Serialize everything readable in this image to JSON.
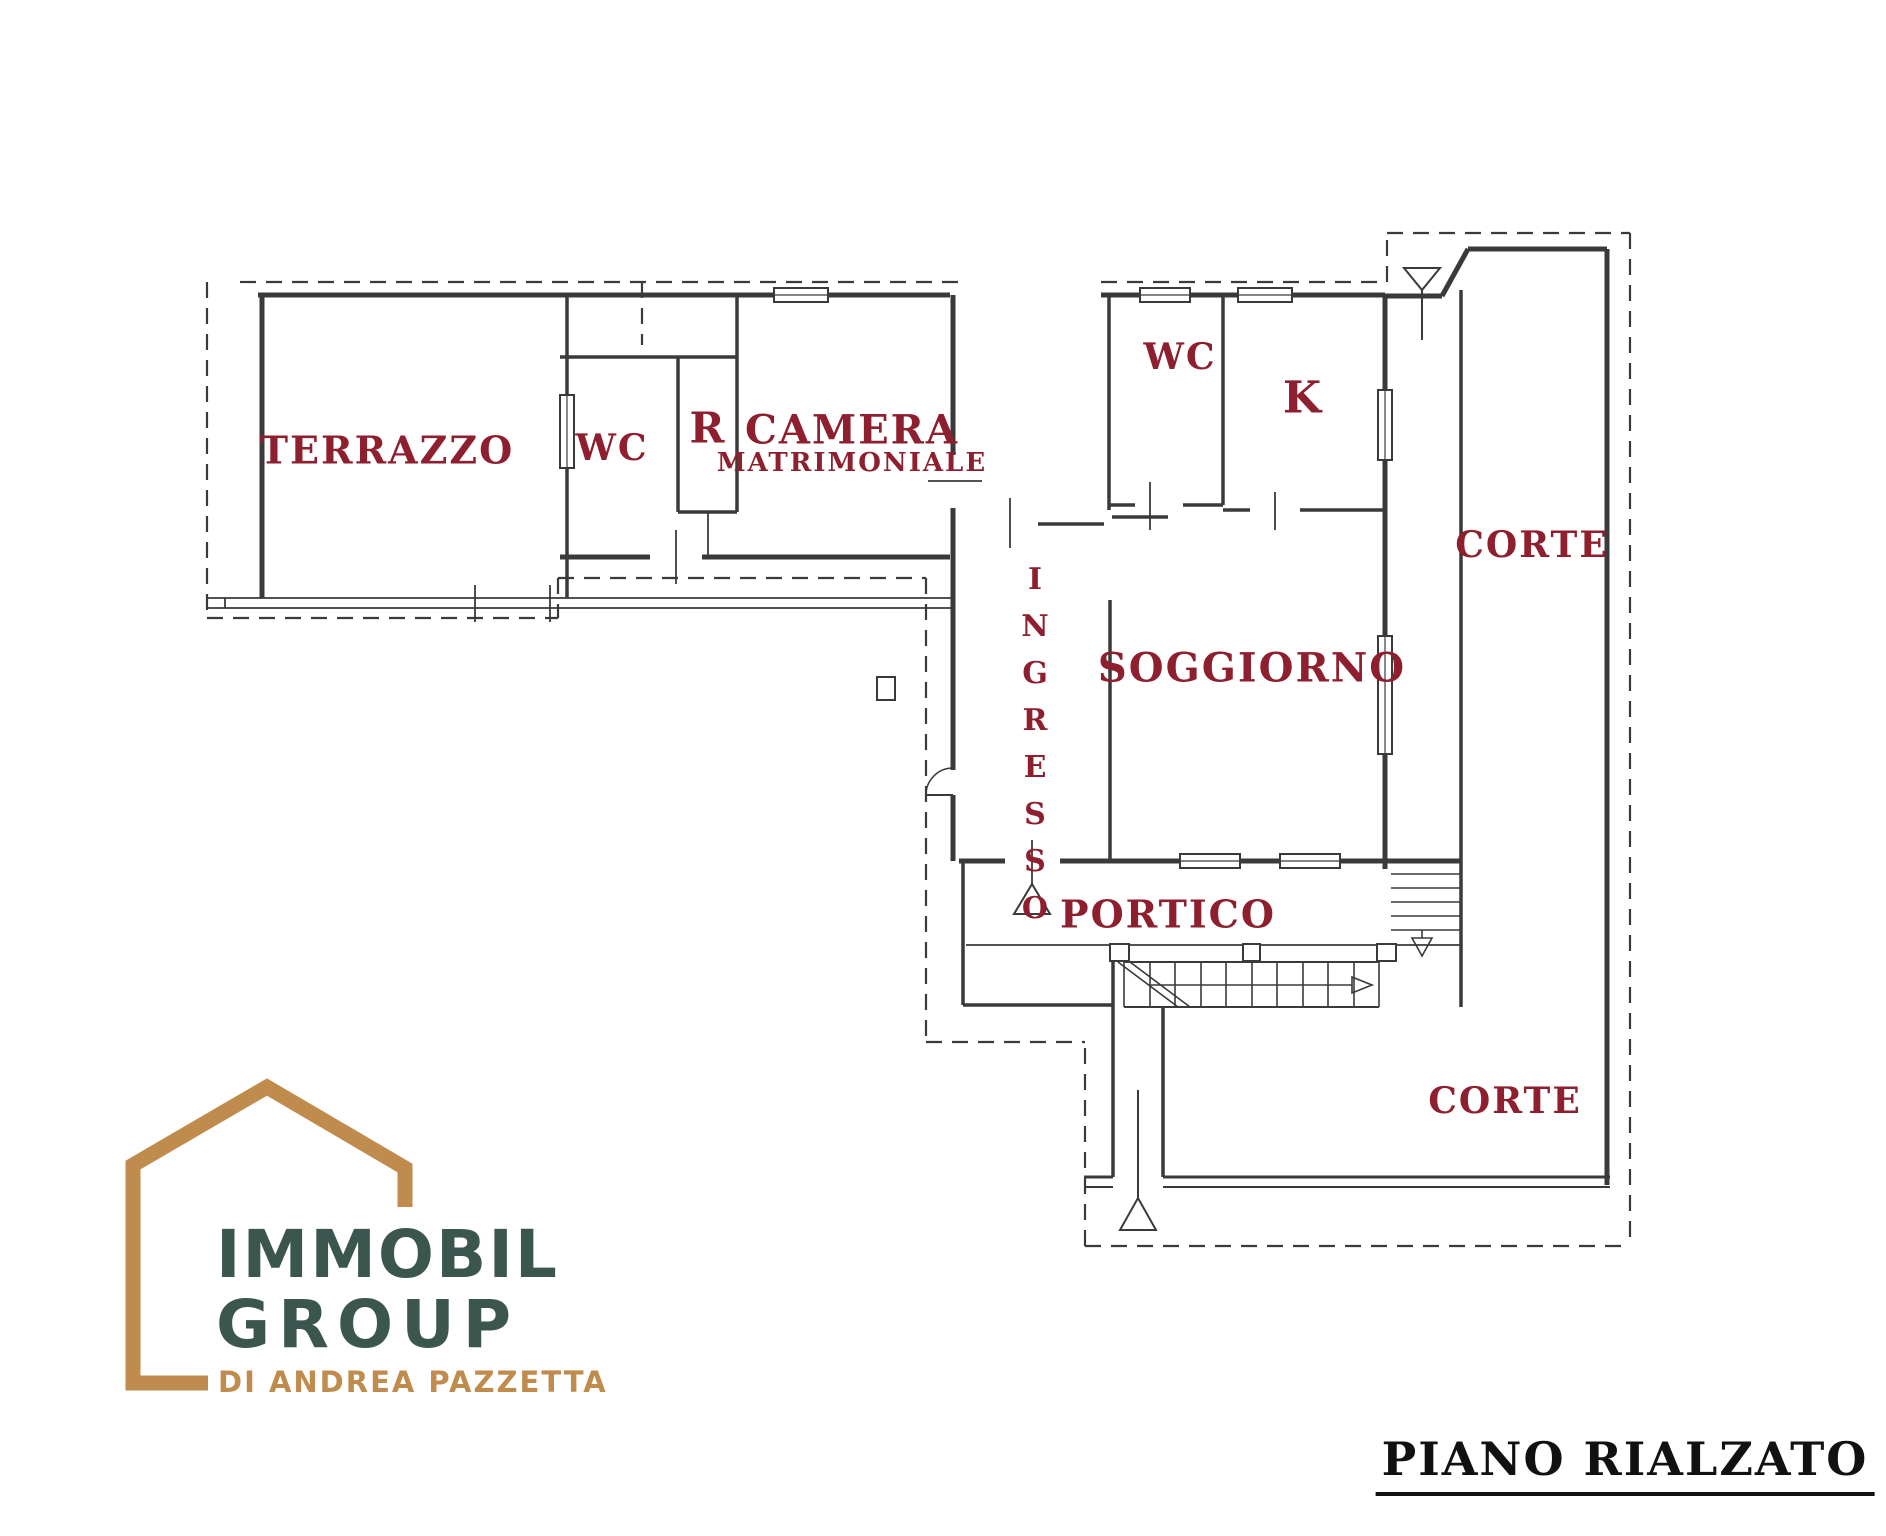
{
  "title": "PIANO RIALZATO",
  "rooms": {
    "terrazzo": "TERRAZZO",
    "wc1": "WC",
    "r": "R",
    "camera1": "CAMERA",
    "camera2": "MATRIMONIALE",
    "wc2": "WC",
    "k": "K",
    "corte_top": "CORTE",
    "ingresso": "INGRESSO",
    "soggiorno": "SOGGIORNO",
    "portico": "PORTICO",
    "corte_bottom": "CORTE"
  },
  "logo": {
    "line1": "IMMOBIL",
    "line2": "GROUP",
    "tagline": "DI ANDREA PAZZETTA"
  },
  "colors": {
    "room_label": "#8e1f2f",
    "plan_line": "#3a3a3a",
    "title": "#111111",
    "logo_house": "#c08c4d",
    "logo_text": "#3b564e",
    "logo_tagline": "#c08c4d"
  }
}
